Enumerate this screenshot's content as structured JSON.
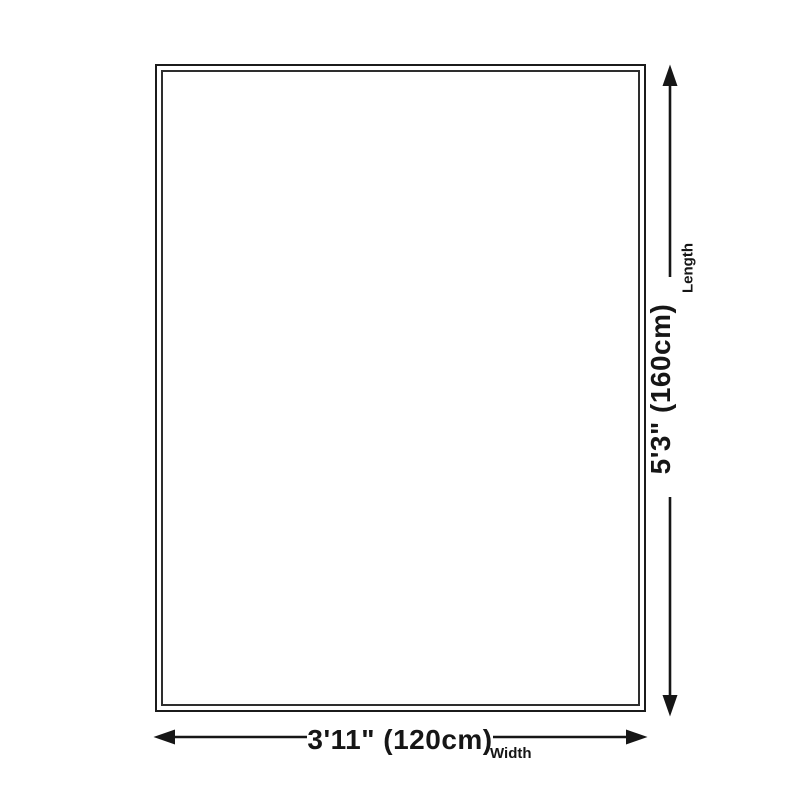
{
  "page": {
    "background_color": "#ffffff",
    "line_color": "#161616",
    "text_color": "#161616"
  },
  "diagram": {
    "kind": "product-size-diagram",
    "length": {
      "value": "5'3\" (160cm)",
      "label": "Length"
    },
    "width": {
      "value": "3'11\" (120cm)",
      "label": "Width"
    }
  }
}
